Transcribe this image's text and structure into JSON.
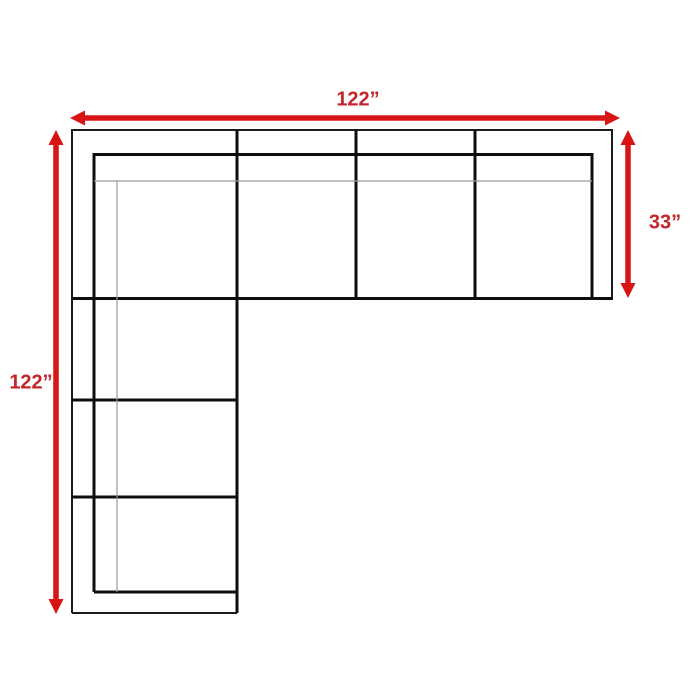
{
  "dimensions": {
    "top": {
      "label": "122”"
    },
    "left": {
      "label": "122”"
    },
    "right": {
      "label": "33”"
    }
  },
  "icons": {
    "top_arrow": "double-headed-horizontal-arrow",
    "left_arrow": "double-headed-vertical-arrow",
    "right_arrow": "double-headed-vertical-arrow"
  },
  "colors": {
    "arrow": "#d81414",
    "label": "#c4252b",
    "line_dark": "#1c1c1c",
    "line_black": "#0e0e0e",
    "line_gray": "#9a9a9a",
    "background": "#ffffff"
  }
}
